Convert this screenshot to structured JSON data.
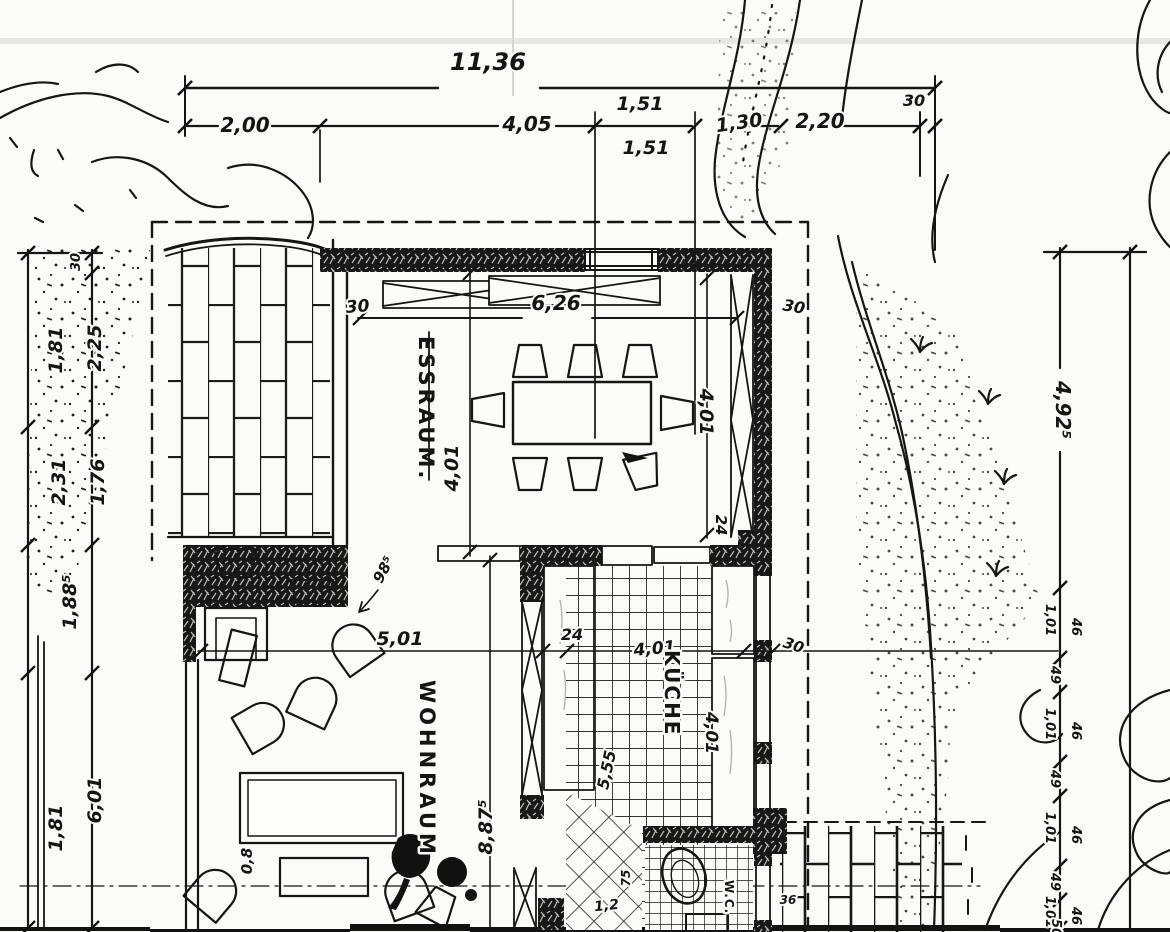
{
  "rooms": {
    "dining_label": "ESSRAUM.",
    "living_label": "WOHNRAUM",
    "kitchen_label": "KÜCHE",
    "wc_label": "W.C."
  },
  "top_dims": {
    "overall": "11,36",
    "seg_200": "2,00",
    "seg_405": "4,05",
    "seg_151a": "1,51",
    "seg_151b": "1,51",
    "seg_130": "1,30",
    "seg_220": "2,20",
    "wall_30": "30"
  },
  "left_dims": {
    "wall_30": "30",
    "seg_225": "2,25",
    "seg_181a": "1,81",
    "seg_176": "1,76",
    "seg_231": "2,31",
    "seg_1885": "1,88⁵",
    "seg_601": "6,01",
    "seg_181b": "1,81"
  },
  "right_dims": {
    "seg_4925": "4,92⁵",
    "win_101a": "1,01",
    "glass_46a": "46",
    "pier_49a": "49",
    "win_101b": "1,01",
    "glass_46b": "46",
    "pier_49b": "49",
    "win_101c": "1,01",
    "glass_46c": "46",
    "pier_49c": "49",
    "win_101d": "1,01",
    "glass_46d": "46",
    "end_50": "50"
  },
  "plan_dims": {
    "terrace_wall_30": "30",
    "dining_width_626": "6,26",
    "dining_wall_30": "30",
    "dining_depth_401_left": "4,01",
    "dining_depth_401_right": "4,01",
    "wall_24_right": "24",
    "living_width_501": "5,01",
    "kitchen_wall_24": "24",
    "kitchen_width_401": "4,01",
    "kitchen_wall_30": "30",
    "kitchen_depth_401": "4,01",
    "kitchen_diag_555": "5,55",
    "living_depth_8875": "8,87⁵",
    "fireplace_985": "98⁵",
    "bench_08": "0,8",
    "wc_75": "75",
    "wc_12": "1,2",
    "paving_36": "36"
  }
}
